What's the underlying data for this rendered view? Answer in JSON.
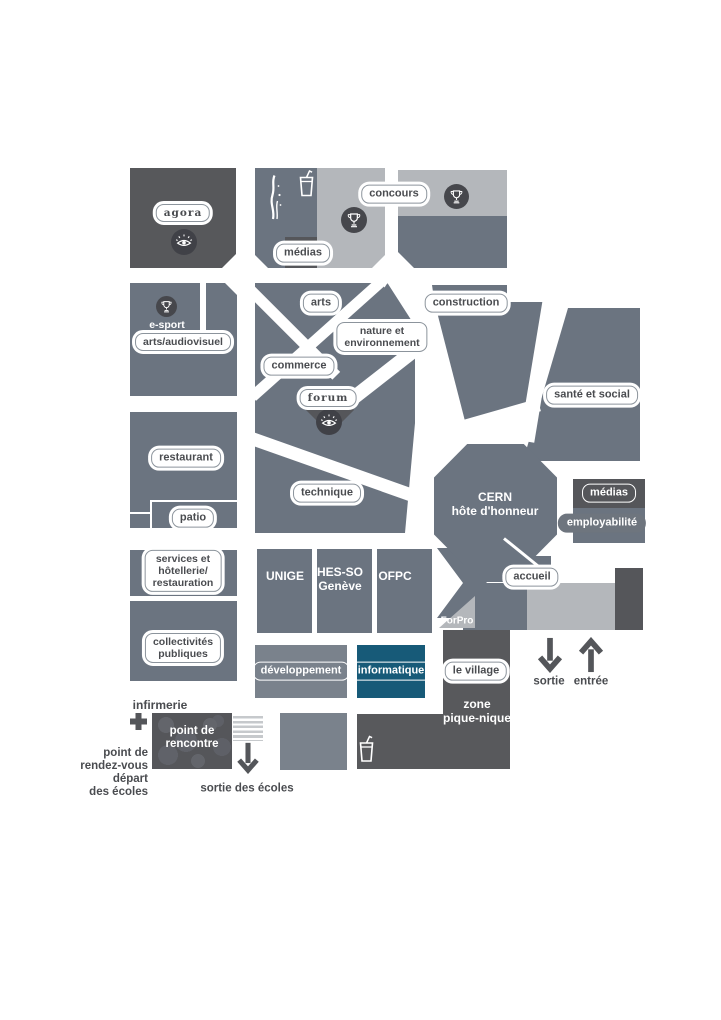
{
  "palette": {
    "block_dark": "#55565A",
    "block_medium": "#6B7480",
    "block_light": "#B4B7BB",
    "block_medium_light": "#7A828C",
    "informatique_teal": "#175A78",
    "label_text": "#4A4C50",
    "arrow": "#54565A"
  },
  "map": {
    "top_row": {
      "agora": "agora",
      "medias": "médias",
      "concours": "concours"
    },
    "left": {
      "esport": "e-sport",
      "arts_audiovisuel": "arts/audiovisuel",
      "restaurant": "restaurant",
      "patio": "patio",
      "services": "services et\nhôtellerie/\nrestauration",
      "collectivites": "collectivités\npubliques"
    },
    "center": {
      "arts": "arts",
      "nature": "nature et\nenvironnement",
      "commerce": "commerce",
      "forum": "forum",
      "technique": "technique",
      "construction": "construction",
      "sante": "santé et social",
      "cern": "CERN\nhôte d'honneur"
    },
    "right": {
      "medias": "médias",
      "employabilite": "employabilité",
      "accueil": "accueil"
    },
    "institutions": {
      "unige": "UNIGE",
      "hesso": "HES-SO\nGenève",
      "ofpc": "OFPC",
      "forpro": "ForPro"
    },
    "bottom": {
      "developpement": "développement",
      "informatique": "informatique",
      "village": "le village",
      "zone_pique_nique": "zone\npique-nique",
      "sortie": "sortie",
      "entree": "entrée"
    },
    "school": {
      "infirmerie": "infirmerie",
      "point_rencontre": "point de\nrencontre",
      "rdv": "point de\nrendez-vous\ndépart\ndes écoles",
      "sortie_ecoles": "sortie des écoles"
    }
  },
  "icons": {
    "eye": "eye-icon",
    "trophy": "trophy-icon",
    "drink": "drink-cup-icon",
    "water_jet": "water-jet-icon",
    "first_aid": "first-aid-cross-icon",
    "crosswalk": "crosswalk-stripes-icon",
    "arrow_down": "arrow-down-icon",
    "arrow_up": "arrow-up-icon"
  }
}
